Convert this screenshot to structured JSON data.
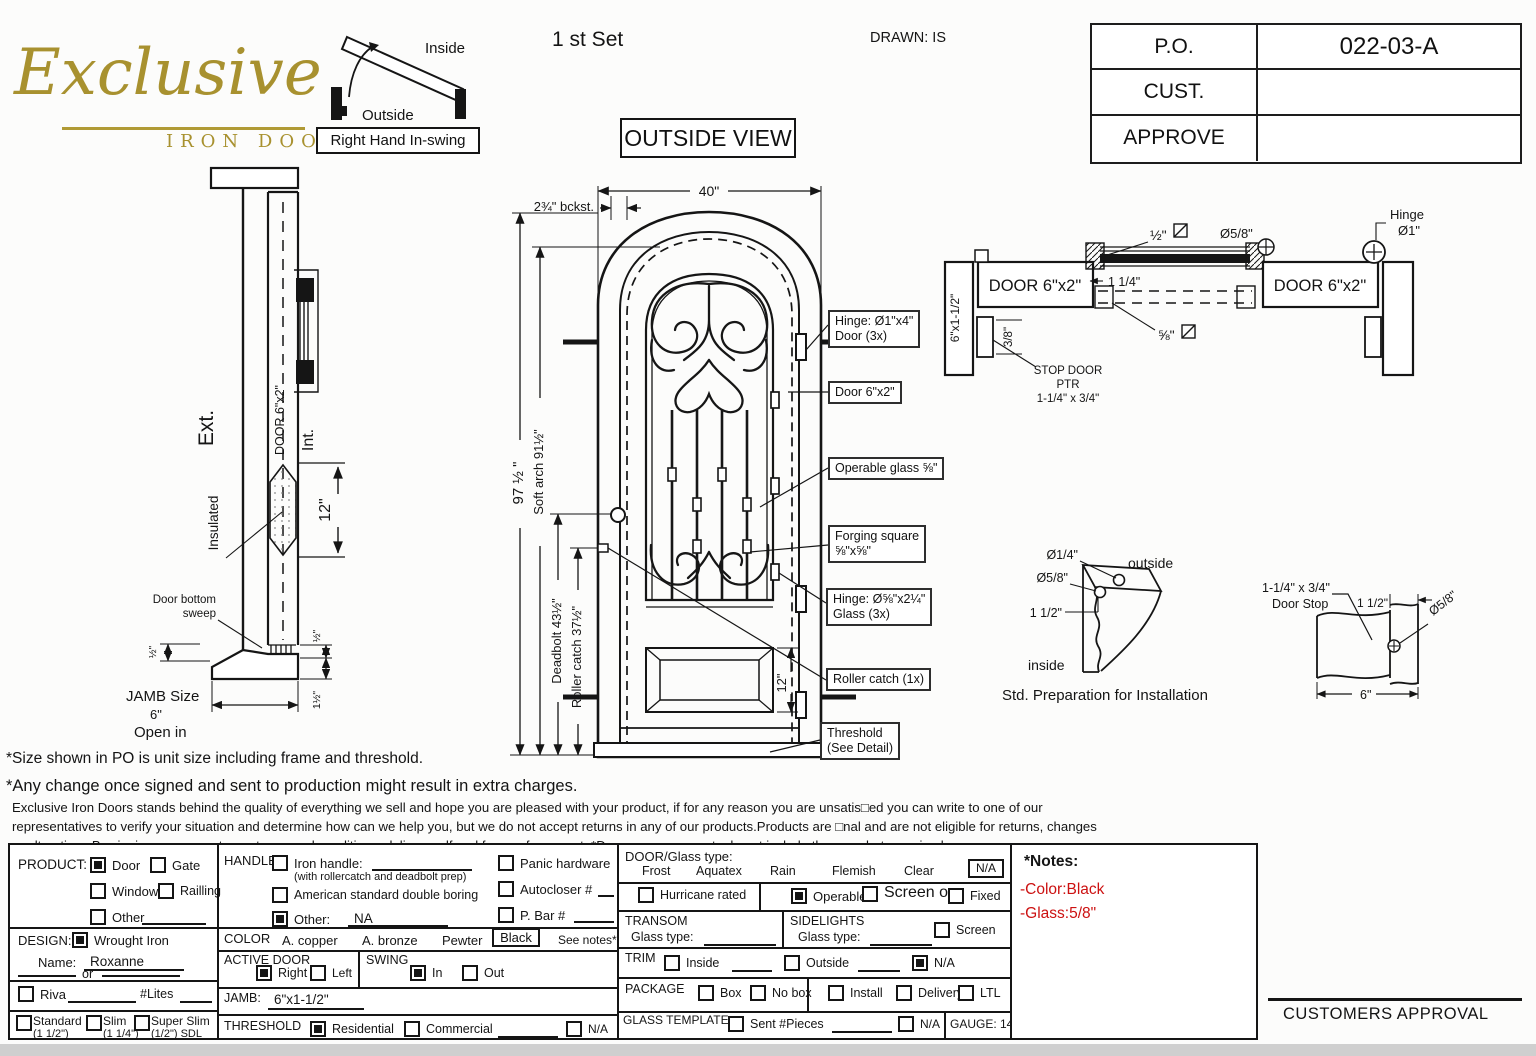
{
  "header": {
    "logo_name": "Exclusive",
    "logo_subtitle": "IRON DOORS",
    "swing_inside": "Inside",
    "swing_outside": "Outside",
    "swing_caption": "Right Hand In-swing",
    "set_label": "1 st Set",
    "drawn_label": "DRAWN: IS",
    "view_label": "OUTSIDE VIEW",
    "po_label": "P.O.",
    "po_value": "022-03-A",
    "cust_label": "CUST.",
    "cust_value": "",
    "approve_label": "APPROVE",
    "approve_value": ""
  },
  "jamb_section": {
    "ext": "Ext.",
    "int": "Int.",
    "door_profile": "DOOR 6\"x2\"",
    "insulated": "Insulated",
    "dim_12": "12\"",
    "sweep1": "Door bottom",
    "sweep2": "sweep",
    "dim_half_left": "½\"",
    "dim_half_right": "½\"",
    "dim_one_half": "1½\"",
    "jamb_size": "JAMB Size",
    "jamb_value": "6\"",
    "open_in": "Open in"
  },
  "door_view": {
    "dim_width": "40\"",
    "backset": "2¾\" bckst.",
    "dim_height": "97 ½ \"",
    "soft_arch": "Soft arch 91½\"",
    "deadbolt": "Deadbolt 43½\"",
    "roller": "Roller catch 37½\"",
    "panel_12": "12\"",
    "co_hinge_door1": "Hinge: Ø1\"x4\"",
    "co_hinge_door2": "Door (3x)",
    "co_door": "Door 6\"x2\"",
    "co_glass": "Operable glass ⅝\"",
    "co_forging1": "Forging square",
    "co_forging2": "⅝\"x⅝\"",
    "co_hinge_glass1": "Hinge: Ø⅝\"x2¼\"",
    "co_hinge_glass2": "Glass (3x)",
    "co_roller": "Roller catch  (1x)",
    "co_threshold1": "Threshold",
    "co_threshold2": "(See Detail)"
  },
  "head_section": {
    "door_left": "DOOR 6\"x2\"",
    "door_right": "DOOR 6\"x2\"",
    "jamb_profile": "6\"x1-1/2\"",
    "dim_38": "3/8\"",
    "stop1": "STOP DOOR",
    "stop2": "PTR",
    "stop3": "1-1/4\" x 3/4\"",
    "dim_half": "½\"",
    "dia_58": "Ø5/8\"",
    "dim_114": "1 1/4\"",
    "dim_58": "⅝\"",
    "hinge1": "Hinge",
    "hinge2": "Ø1\""
  },
  "std_prep": {
    "dia_14": "Ø1/4\"",
    "dia_58": "Ø5/8\"",
    "dim_112": "1 1/2\"",
    "outside": "outside",
    "inside": "inside",
    "caption": "Std. Preparation for Installation"
  },
  "stop_detail": {
    "size": "1-1/4\" x 3/4\"",
    "name": "Door Stop",
    "dim_112": "1 1/2\"",
    "dia_58": "Ø5/8\"",
    "dim_6": "6\""
  },
  "disclaimer": {
    "line1": "*Size shown in PO is unit size including frame and threshold.",
    "line2": "*Any change once signed and sent to production might result in extra charges.",
    "para1": "Exclusive Iron Doors stands behind the quality of everything we sell and hope you are pleased with your product, if for any reason you are unsatis□ed you can write to one of our",
    "para2": "representatives to verify your situation and determine how can we help you, but we do not accept returns in any of our products.Products are □nal and are not eligible for returns, changes",
    "para3": "or alterations.By signing you agree to our terms and conditions, delivery pdf and forms of payment. *Doors measurements do not include the gaps between jambs"
  },
  "form": {
    "product": {
      "label": "PRODUCT:",
      "door": "Door",
      "door_checked": true,
      "gate": "Gate",
      "gate_checked": false,
      "window": "Window",
      "window_checked": false,
      "railing": "Railling",
      "railing_checked": false,
      "other": "Other",
      "other_checked": false
    },
    "handle": {
      "label": "HANDLE",
      "iron": "Iron handle:",
      "iron_checked": false,
      "iron_sub": "(with rollercatch and deadbolt prep)",
      "american": "American standard double boring",
      "american_checked": false,
      "other": "Other:",
      "other_checked": true,
      "other_value": "NA",
      "panic": "Panic hardware",
      "panic_checked": false,
      "autocloser": "Autocloser #",
      "autocloser_checked": false,
      "pbar": "P. Bar #",
      "pbar_checked": false
    },
    "color": {
      "label": "COLOR",
      "opt1": "A. copper",
      "opt2": "A. bronze",
      "opt3": "Pewter",
      "selected": "Black",
      "note": "See notes*"
    },
    "design": {
      "label": "DESIGN:",
      "wrought": "Wrought Iron",
      "wrought_checked": true,
      "name_label": "Name:",
      "name_value": "Roxanne",
      "or_label": "or"
    },
    "riva": {
      "label": "Riva",
      "checked": false,
      "lites": "#Lites"
    },
    "sdl": {
      "standard": "Standard",
      "standard_sub": "(1 1/2\")",
      "standard_checked": false,
      "slim": "Slim",
      "slim_sub": "(1 1/4\")",
      "slim_checked": false,
      "super": "Super Slim",
      "super_sub": "(1/2\") SDL",
      "super_checked": false
    },
    "active_door": {
      "label": "ACTIVE DOOR",
      "right": "Right",
      "right_checked": true,
      "left": "Left",
      "left_checked": false
    },
    "swing": {
      "label": "SWING",
      "in": "In",
      "in_checked": true,
      "out": "Out",
      "out_checked": false
    },
    "jamb": {
      "label": "JAMB:",
      "value": "6\"x1-1/2\""
    },
    "threshold": {
      "label": "THRESHOLD",
      "residential": "Residential",
      "residential_checked": true,
      "commercial": "Commercial",
      "commercial_checked": false,
      "na": "N/A",
      "na_checked": false
    },
    "door_glass": {
      "label": "DOOR/Glass type:",
      "opt1": "Frost",
      "opt2": "Aquatex",
      "opt3": "Rain",
      "opt4": "Flemish",
      "opt5": "Clear",
      "na": "N/A"
    },
    "glazing": {
      "hurricane": "Hurricane rated",
      "hurricane_checked": false,
      "operable": "Operable",
      "operable_checked": true,
      "screen": "Screen or",
      "screen_checked": false,
      "fixed": "Fixed",
      "fixed_checked": false
    },
    "transom": {
      "label": "TRANSOM",
      "glass": "Glass type:"
    },
    "sidelights": {
      "label": "SIDELIGHTS",
      "glass": "Glass type:",
      "screen": "Screen",
      "screen_checked": false
    },
    "trim": {
      "label": "TRIM",
      "inside": "Inside",
      "inside_checked": false,
      "outside": "Outside",
      "outside_checked": false,
      "na": "N/A",
      "na_checked": true
    },
    "package": {
      "label": "PACKAGE",
      "box": "Box",
      "box_checked": false,
      "nobox": "No box",
      "nobox_checked": false,
      "install": "Install",
      "install_checked": false,
      "delivery": "Delivery",
      "delivery_checked": false,
      "ltl": "LTL",
      "ltl_checked": false
    },
    "glass_template": {
      "label": "GLASS TEMPLATE",
      "sent": "Sent #Pieces",
      "sent_checked": false,
      "na": "N/A",
      "na_checked": false,
      "gauge": "GAUGE: 14"
    }
  },
  "notes": {
    "title": "*Notes:",
    "line1": "-Color:Black",
    "line2": "-Glass:5/8\""
  },
  "approval": "CUSTOMERS APPROVAL"
}
